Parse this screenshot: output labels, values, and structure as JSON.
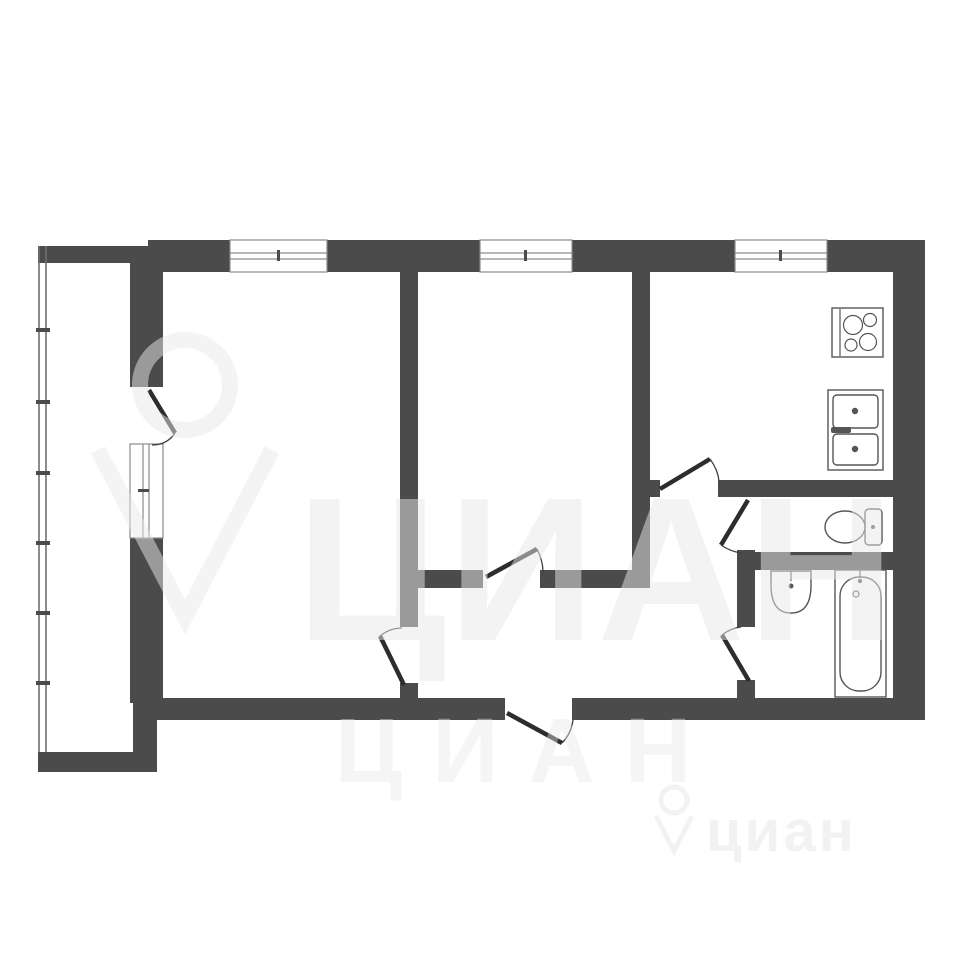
{
  "page": {
    "title": "apartment-floor-plan",
    "background": "#ffffff"
  },
  "colors": {
    "wall": "#4b4b4b",
    "door_leaf": "#2d2d2d",
    "door_arc": "#3f3f3f",
    "window_frame": "#8a8a8a",
    "fixture_stroke": "#555555",
    "watermark": "#e9e9e9"
  },
  "watermark": {
    "large": {
      "text": "ЦИАН"
    },
    "medium": {
      "text": "ЦИАН"
    },
    "small": {
      "text": "циан"
    }
  },
  "shapes": [
    {
      "tag": "rect",
      "layer": "plan-layer",
      "name": "top-wall-a",
      "cls": "wall",
      "attrs": {
        "x": 148,
        "y": 240,
        "width": 82,
        "height": 32
      }
    },
    {
      "tag": "rect",
      "layer": "plan-layer",
      "name": "top-wall-b",
      "cls": "wall",
      "attrs": {
        "x": 327,
        "y": 240,
        "width": 153,
        "height": 32
      }
    },
    {
      "tag": "rect",
      "layer": "plan-layer",
      "name": "top-wall-c",
      "cls": "wall",
      "attrs": {
        "x": 572,
        "y": 240,
        "width": 163,
        "height": 32
      }
    },
    {
      "tag": "rect",
      "layer": "plan-layer",
      "name": "top-wall-d",
      "cls": "wall",
      "attrs": {
        "x": 827,
        "y": 240,
        "width": 98,
        "height": 32
      }
    },
    {
      "tag": "rect",
      "layer": "plan-layer",
      "name": "right-wall",
      "cls": "wall",
      "attrs": {
        "x": 893,
        "y": 270,
        "width": 32,
        "height": 450
      }
    },
    {
      "tag": "rect",
      "layer": "plan-layer",
      "name": "bottom-wall-left",
      "cls": "wall",
      "attrs": {
        "x": 140,
        "y": 698,
        "width": 365,
        "height": 22
      }
    },
    {
      "tag": "rect",
      "layer": "plan-layer",
      "name": "bottom-wall-right",
      "cls": "wall",
      "attrs": {
        "x": 572,
        "y": 698,
        "width": 353,
        "height": 22
      }
    },
    {
      "tag": "rect",
      "layer": "plan-layer",
      "name": "left-wall-upper",
      "cls": "wall",
      "attrs": {
        "x": 130,
        "y": 263,
        "width": 33,
        "height": 124
      }
    },
    {
      "tag": "rect",
      "layer": "plan-layer",
      "name": "left-wall-lower",
      "cls": "wall",
      "attrs": {
        "x": 130,
        "y": 538,
        "width": 33,
        "height": 165
      }
    },
    {
      "tag": "rect",
      "layer": "plan-layer",
      "name": "left-wall-foot",
      "cls": "wall",
      "attrs": {
        "x": 133,
        "y": 700,
        "width": 24,
        "height": 55
      }
    },
    {
      "tag": "rect",
      "layer": "plan-layer",
      "name": "balcony-top-wall",
      "cls": "wall",
      "attrs": {
        "x": 38,
        "y": 246,
        "width": 110,
        "height": 17
      }
    },
    {
      "tag": "rect",
      "layer": "plan-layer",
      "name": "balcony-bottom-wall",
      "cls": "wall",
      "attrs": {
        "x": 38,
        "y": 752,
        "width": 119,
        "height": 20
      }
    },
    {
      "tag": "rect",
      "layer": "plan-layer",
      "name": "rooms-divider-wall",
      "cls": "wall",
      "attrs": {
        "x": 400,
        "y": 272,
        "width": 18,
        "height": 355
      }
    },
    {
      "tag": "rect",
      "layer": "plan-layer",
      "name": "rooms-divider-stub",
      "cls": "wall",
      "attrs": {
        "x": 400,
        "y": 683,
        "width": 18,
        "height": 15
      }
    },
    {
      "tag": "rect",
      "layer": "plan-layer",
      "name": "hall-wall-west",
      "cls": "wall",
      "attrs": {
        "x": 418,
        "y": 570,
        "width": 65,
        "height": 18
      }
    },
    {
      "tag": "rect",
      "layer": "plan-layer",
      "name": "hall-wall-east",
      "cls": "wall",
      "attrs": {
        "x": 540,
        "y": 570,
        "width": 110,
        "height": 18
      }
    },
    {
      "tag": "rect",
      "layer": "plan-layer",
      "name": "kitchen-west-wall",
      "cls": "wall",
      "attrs": {
        "x": 632,
        "y": 272,
        "width": 18,
        "height": 316
      }
    },
    {
      "tag": "rect",
      "layer": "plan-layer",
      "name": "kitchen-door-stub",
      "cls": "wall",
      "attrs": {
        "x": 650,
        "y": 480,
        "width": 10,
        "height": 17
      }
    },
    {
      "tag": "rect",
      "layer": "plan-layer",
      "name": "kitchen-hall-wall",
      "cls": "wall",
      "attrs": {
        "x": 718,
        "y": 480,
        "width": 175,
        "height": 17
      }
    },
    {
      "tag": "rect",
      "layer": "plan-layer",
      "name": "wc-west-wall",
      "cls": "wall",
      "attrs": {
        "x": 737,
        "y": 550,
        "width": 18,
        "height": 77
      }
    },
    {
      "tag": "rect",
      "layer": "plan-layer",
      "name": "bath-west-wall-foot",
      "cls": "wall",
      "attrs": {
        "x": 737,
        "y": 680,
        "width": 18,
        "height": 18
      }
    },
    {
      "tag": "rect",
      "layer": "plan-layer",
      "name": "wc-bath-wall",
      "cls": "wall",
      "attrs": {
        "x": 737,
        "y": 552,
        "width": 156,
        "height": 18
      }
    },
    {
      "tag": "rect",
      "layer": "plan-layer",
      "name": "window-1-frame",
      "cls": "winframe",
      "attrs": {
        "x": 230,
        "y": 240,
        "width": 97,
        "height": 32
      }
    },
    {
      "tag": "line",
      "layer": "plan-layer",
      "name": "window-1-glass-a",
      "cls": "winline",
      "attrs": {
        "x1": 230,
        "y1": 253,
        "x2": 327,
        "y2": 253
      }
    },
    {
      "tag": "line",
      "layer": "plan-layer",
      "name": "window-1-glass-b",
      "cls": "winline",
      "attrs": {
        "x1": 230,
        "y1": 259,
        "x2": 327,
        "y2": 259
      }
    },
    {
      "tag": "rect",
      "layer": "plan-layer",
      "name": "window-1-mullion",
      "cls": "tick",
      "attrs": {
        "x": 277,
        "y": 250,
        "width": 3,
        "height": 11
      }
    },
    {
      "tag": "rect",
      "layer": "plan-layer",
      "name": "window-2-frame",
      "cls": "winframe",
      "attrs": {
        "x": 480,
        "y": 240,
        "width": 92,
        "height": 32
      }
    },
    {
      "tag": "line",
      "layer": "plan-layer",
      "name": "window-2-glass-a",
      "cls": "winline",
      "attrs": {
        "x1": 480,
        "y1": 253,
        "x2": 572,
        "y2": 253
      }
    },
    {
      "tag": "line",
      "layer": "plan-layer",
      "name": "window-2-glass-b",
      "cls": "winline",
      "attrs": {
        "x1": 480,
        "y1": 259,
        "x2": 572,
        "y2": 259
      }
    },
    {
      "tag": "rect",
      "layer": "plan-layer",
      "name": "window-2-mullion",
      "cls": "tick",
      "attrs": {
        "x": 524,
        "y": 250,
        "width": 3,
        "height": 11
      }
    },
    {
      "tag": "rect",
      "layer": "plan-layer",
      "name": "window-3-frame",
      "cls": "winframe",
      "attrs": {
        "x": 735,
        "y": 240,
        "width": 92,
        "height": 32
      }
    },
    {
      "tag": "line",
      "layer": "plan-layer",
      "name": "window-3-glass-a",
      "cls": "winline",
      "attrs": {
        "x1": 735,
        "y1": 253,
        "x2": 827,
        "y2": 253
      }
    },
    {
      "tag": "line",
      "layer": "plan-layer",
      "name": "window-3-glass-b",
      "cls": "winline",
      "attrs": {
        "x1": 735,
        "y1": 259,
        "x2": 827,
        "y2": 259
      }
    },
    {
      "tag": "rect",
      "layer": "plan-layer",
      "name": "window-3-mullion",
      "cls": "tick",
      "attrs": {
        "x": 779,
        "y": 250,
        "width": 3,
        "height": 11
      }
    },
    {
      "tag": "rect",
      "layer": "plan-layer",
      "name": "balcony-window-frame",
      "cls": "winframe",
      "attrs": {
        "x": 130,
        "y": 444,
        "width": 33,
        "height": 94
      }
    },
    {
      "tag": "line",
      "layer": "plan-layer",
      "name": "balcony-window-glass-a",
      "cls": "winline",
      "attrs": {
        "x1": 143,
        "y1": 444,
        "x2": 143,
        "y2": 538
      }
    },
    {
      "tag": "line",
      "layer": "plan-layer",
      "name": "balcony-window-glass-b",
      "cls": "winline",
      "attrs": {
        "x1": 149,
        "y1": 444,
        "x2": 149,
        "y2": 538
      }
    },
    {
      "tag": "rect",
      "layer": "plan-layer",
      "name": "balcony-window-mullion",
      "cls": "tick",
      "attrs": {
        "x": 138,
        "y": 489,
        "width": 11,
        "height": 3
      }
    },
    {
      "tag": "line",
      "layer": "plan-layer",
      "name": "balcony-glazing-outer",
      "cls": "glz",
      "attrs": {
        "x1": 39,
        "y1": 246,
        "x2": 39,
        "y2": 752
      }
    },
    {
      "tag": "line",
      "layer": "plan-layer",
      "name": "balcony-glazing-inner",
      "cls": "glz",
      "attrs": {
        "x1": 46,
        "y1": 246,
        "x2": 46,
        "y2": 752
      }
    },
    {
      "tag": "rect",
      "layer": "plan-layer",
      "name": "glazing-mullion-1",
      "cls": "tick",
      "attrs": {
        "x": 36,
        "y": 328,
        "width": 14,
        "height": 4
      }
    },
    {
      "tag": "rect",
      "layer": "plan-layer",
      "name": "glazing-mullion-2",
      "cls": "tick",
      "attrs": {
        "x": 36,
        "y": 400,
        "width": 14,
        "height": 4
      }
    },
    {
      "tag": "rect",
      "layer": "plan-layer",
      "name": "glazing-mullion-3",
      "cls": "tick",
      "attrs": {
        "x": 36,
        "y": 471,
        "width": 14,
        "height": 4
      }
    },
    {
      "tag": "rect",
      "layer": "plan-layer",
      "name": "glazing-mullion-4",
      "cls": "tick",
      "attrs": {
        "x": 36,
        "y": 541,
        "width": 14,
        "height": 4
      }
    },
    {
      "tag": "rect",
      "layer": "plan-layer",
      "name": "glazing-mullion-5",
      "cls": "tick",
      "attrs": {
        "x": 36,
        "y": 611,
        "width": 14,
        "height": 4
      }
    },
    {
      "tag": "rect",
      "layer": "plan-layer",
      "name": "glazing-mullion-6",
      "cls": "tick",
      "attrs": {
        "x": 36,
        "y": 681,
        "width": 14,
        "height": 4
      }
    },
    {
      "tag": "line",
      "layer": "plan-layer",
      "name": "balcony-door-leaf",
      "cls": "leaf",
      "attrs": {
        "x1": 149,
        "y1": 390,
        "x2": 175,
        "y2": 433
      }
    },
    {
      "tag": "path",
      "layer": "plan-layer",
      "name": "balcony-door-arc",
      "cls": "arc",
      "attrs": {
        "d": "M175,433 Q167,445 152,445"
      }
    },
    {
      "tag": "line",
      "layer": "plan-layer",
      "name": "living-room-door-leaf",
      "cls": "leaf",
      "attrs": {
        "x1": 404,
        "y1": 685,
        "x2": 380,
        "y2": 636
      }
    },
    {
      "tag": "path",
      "layer": "plan-layer",
      "name": "living-room-door-arc",
      "cls": "arc",
      "attrs": {
        "d": "M380,636 Q390,628 402,628"
      }
    },
    {
      "tag": "line",
      "layer": "plan-layer",
      "name": "middle-room-door-leaf",
      "cls": "leaf",
      "attrs": {
        "x1": 486,
        "y1": 577,
        "x2": 537,
        "y2": 549
      }
    },
    {
      "tag": "path",
      "layer": "plan-layer",
      "name": "middle-room-door-arc",
      "cls": "arc",
      "attrs": {
        "d": "M537,549 Q543,561 543,572"
      }
    },
    {
      "tag": "line",
      "layer": "plan-layer",
      "name": "entrance-door-leaf",
      "cls": "leaf",
      "attrs": {
        "x1": 507,
        "y1": 713,
        "x2": 562,
        "y2": 743
      }
    },
    {
      "tag": "path",
      "layer": "plan-layer",
      "name": "entrance-door-arc",
      "cls": "arc",
      "attrs": {
        "d": "M562,743 Q571,734 573,720"
      }
    },
    {
      "tag": "line",
      "layer": "plan-layer",
      "name": "kitchen-door-leaf",
      "cls": "leaf",
      "attrs": {
        "x1": 660,
        "y1": 489,
        "x2": 710,
        "y2": 459
      }
    },
    {
      "tag": "path",
      "layer": "plan-layer",
      "name": "kitchen-door-arc",
      "cls": "arc",
      "attrs": {
        "d": "M710,459 Q718,470 719,481"
      }
    },
    {
      "tag": "line",
      "layer": "plan-layer",
      "name": "wc-door-leaf",
      "cls": "leaf",
      "attrs": {
        "x1": 748,
        "y1": 500,
        "x2": 721,
        "y2": 545
      }
    },
    {
      "tag": "path",
      "layer": "plan-layer",
      "name": "wc-door-arc",
      "cls": "arc",
      "attrs": {
        "d": "M721,545 Q731,552 742,553"
      }
    },
    {
      "tag": "line",
      "layer": "plan-layer",
      "name": "bathroom-door-leaf",
      "cls": "leaf",
      "attrs": {
        "x1": 749,
        "y1": 681,
        "x2": 722,
        "y2": 635
      }
    },
    {
      "tag": "path",
      "layer": "plan-layer",
      "name": "bathroom-door-arc",
      "cls": "arc",
      "attrs": {
        "d": "M722,635 Q731,628 741,627"
      }
    },
    {
      "tag": "rect",
      "layer": "plan-layer",
      "name": "stove-body",
      "cls": "fx",
      "attrs": {
        "x": 832,
        "y": 308,
        "width": 51,
        "height": 49
      }
    },
    {
      "tag": "line",
      "layer": "plan-layer",
      "name": "stove-panel-line",
      "cls": "fxline",
      "attrs": {
        "x1": 840,
        "y1": 309,
        "x2": 840,
        "y2": 356
      }
    },
    {
      "tag": "circle",
      "layer": "plan-layer",
      "name": "stove-burner-1",
      "cls": "fxline",
      "attrs": {
        "cx": 853,
        "cy": 325,
        "r": 9.5
      }
    },
    {
      "tag": "circle",
      "layer": "plan-layer",
      "name": "stove-burner-2",
      "cls": "fxline",
      "attrs": {
        "cx": 870,
        "cy": 320,
        "r": 6.5
      }
    },
    {
      "tag": "circle",
      "layer": "plan-layer",
      "name": "stove-burner-3",
      "cls": "fxline",
      "attrs": {
        "cx": 851,
        "cy": 345,
        "r": 6
      }
    },
    {
      "tag": "circle",
      "layer": "plan-layer",
      "name": "stove-burner-4",
      "cls": "fxline",
      "attrs": {
        "cx": 868,
        "cy": 342,
        "r": 8.5
      }
    },
    {
      "tag": "rect",
      "layer": "plan-layer",
      "name": "kitchen-sink-body",
      "cls": "fx",
      "attrs": {
        "x": 828,
        "y": 390,
        "width": 55,
        "height": 80
      }
    },
    {
      "tag": "rect",
      "layer": "plan-layer",
      "name": "kitchen-sink-basin-top",
      "cls": "fx",
      "attrs": {
        "x": 833,
        "y": 395,
        "width": 45,
        "height": 33,
        "rx": 4
      }
    },
    {
      "tag": "rect",
      "layer": "plan-layer",
      "name": "kitchen-sink-basin-bottom",
      "cls": "fx",
      "attrs": {
        "x": 833,
        "y": 434,
        "width": 45,
        "height": 31,
        "rx": 4
      }
    },
    {
      "tag": "circle",
      "layer": "plan-layer",
      "name": "kitchen-sink-drain-top",
      "cls": "fxdot",
      "attrs": {
        "cx": 855,
        "cy": 411,
        "r": 3.2
      }
    },
    {
      "tag": "circle",
      "layer": "plan-layer",
      "name": "kitchen-sink-drain-bottom",
      "cls": "fxdot",
      "attrs": {
        "cx": 855,
        "cy": 449,
        "r": 3.2
      }
    },
    {
      "tag": "rect",
      "layer": "plan-layer",
      "name": "kitchen-sink-faucet",
      "cls": "fxdot",
      "attrs": {
        "x": 831,
        "y": 427,
        "width": 20,
        "height": 6,
        "rx": 2
      }
    },
    {
      "tag": "rect",
      "layer": "plan-layer",
      "name": "toilet-tank",
      "cls": "fx",
      "attrs": {
        "x": 865,
        "y": 509,
        "width": 17,
        "height": 36,
        "rx": 4
      }
    },
    {
      "tag": "ellipse",
      "layer": "plan-layer",
      "name": "toilet-bowl",
      "cls": "fx",
      "attrs": {
        "cx": 845,
        "cy": 527,
        "rx": 20,
        "ry": 16
      }
    },
    {
      "tag": "circle",
      "layer": "plan-layer",
      "name": "toilet-flush-button",
      "cls": "fxdot",
      "attrs": {
        "cx": 873,
        "cy": 527,
        "r": 2
      }
    },
    {
      "tag": "path",
      "layer": "plan-layer",
      "name": "washbasin-body",
      "cls": "fx",
      "attrs": {
        "d": "M771,571 L811,571 L811,585 Q811,613 791,613 Q771,613 771,585 Z"
      }
    },
    {
      "tag": "line",
      "layer": "plan-layer",
      "name": "washbasin-faucet-line",
      "cls": "fxline",
      "attrs": {
        "x1": 791,
        "y1": 571,
        "x2": 791,
        "y2": 581
      }
    },
    {
      "tag": "circle",
      "layer": "plan-layer",
      "name": "washbasin-faucet-dot",
      "cls": "fxdot",
      "attrs": {
        "cx": 791,
        "cy": 586,
        "r": 2.5
      }
    },
    {
      "tag": "rect",
      "layer": "plan-layer",
      "name": "bathtub-body",
      "cls": "fx",
      "attrs": {
        "x": 835,
        "y": 570,
        "width": 51,
        "height": 127
      }
    },
    {
      "tag": "rect",
      "layer": "plan-layer",
      "name": "bathtub-inner",
      "cls": "fx",
      "attrs": {
        "x": 840,
        "y": 577,
        "width": 41,
        "height": 114,
        "rx": 19
      }
    },
    {
      "tag": "line",
      "layer": "plan-layer",
      "name": "bathtub-faucet-line",
      "cls": "fxline",
      "attrs": {
        "x1": 860,
        "y1": 568,
        "x2": 860,
        "y2": 578
      }
    },
    {
      "tag": "circle",
      "layer": "plan-layer",
      "name": "bathtub-faucet-dot",
      "cls": "fxdot",
      "attrs": {
        "cx": 860,
        "cy": 581,
        "r": 2.2
      }
    },
    {
      "tag": "circle",
      "layer": "plan-layer",
      "name": "bathtub-drain",
      "cls": "fxline",
      "attrs": {
        "cx": 856,
        "cy": 594,
        "r": 3
      }
    },
    {
      "tag": "circle",
      "layer": "wm-large",
      "name": "watermark-pin-ring-icon",
      "cls": "wmstroke",
      "attrs": {
        "cx": 185,
        "cy": 385,
        "r": 45
      }
    },
    {
      "tag": "path",
      "layer": "wm-large",
      "name": "watermark-pin-point-icon",
      "cls": "wmstroke",
      "attrs": {
        "d": "M98,450 L185,617 L272,450"
      }
    },
    {
      "tag": "circle",
      "layer": "wm-small",
      "name": "watermark-small-pin-ring-icon",
      "cls": "wmstroke-sm",
      "attrs": {
        "cx": 674,
        "cy": 800,
        "r": 13
      }
    },
    {
      "tag": "path",
      "layer": "wm-small",
      "name": "watermark-small-pin-point-icon",
      "cls": "wmstroke-sm",
      "attrs": {
        "d": "M656,816 L674,851 L692,816"
      }
    }
  ]
}
